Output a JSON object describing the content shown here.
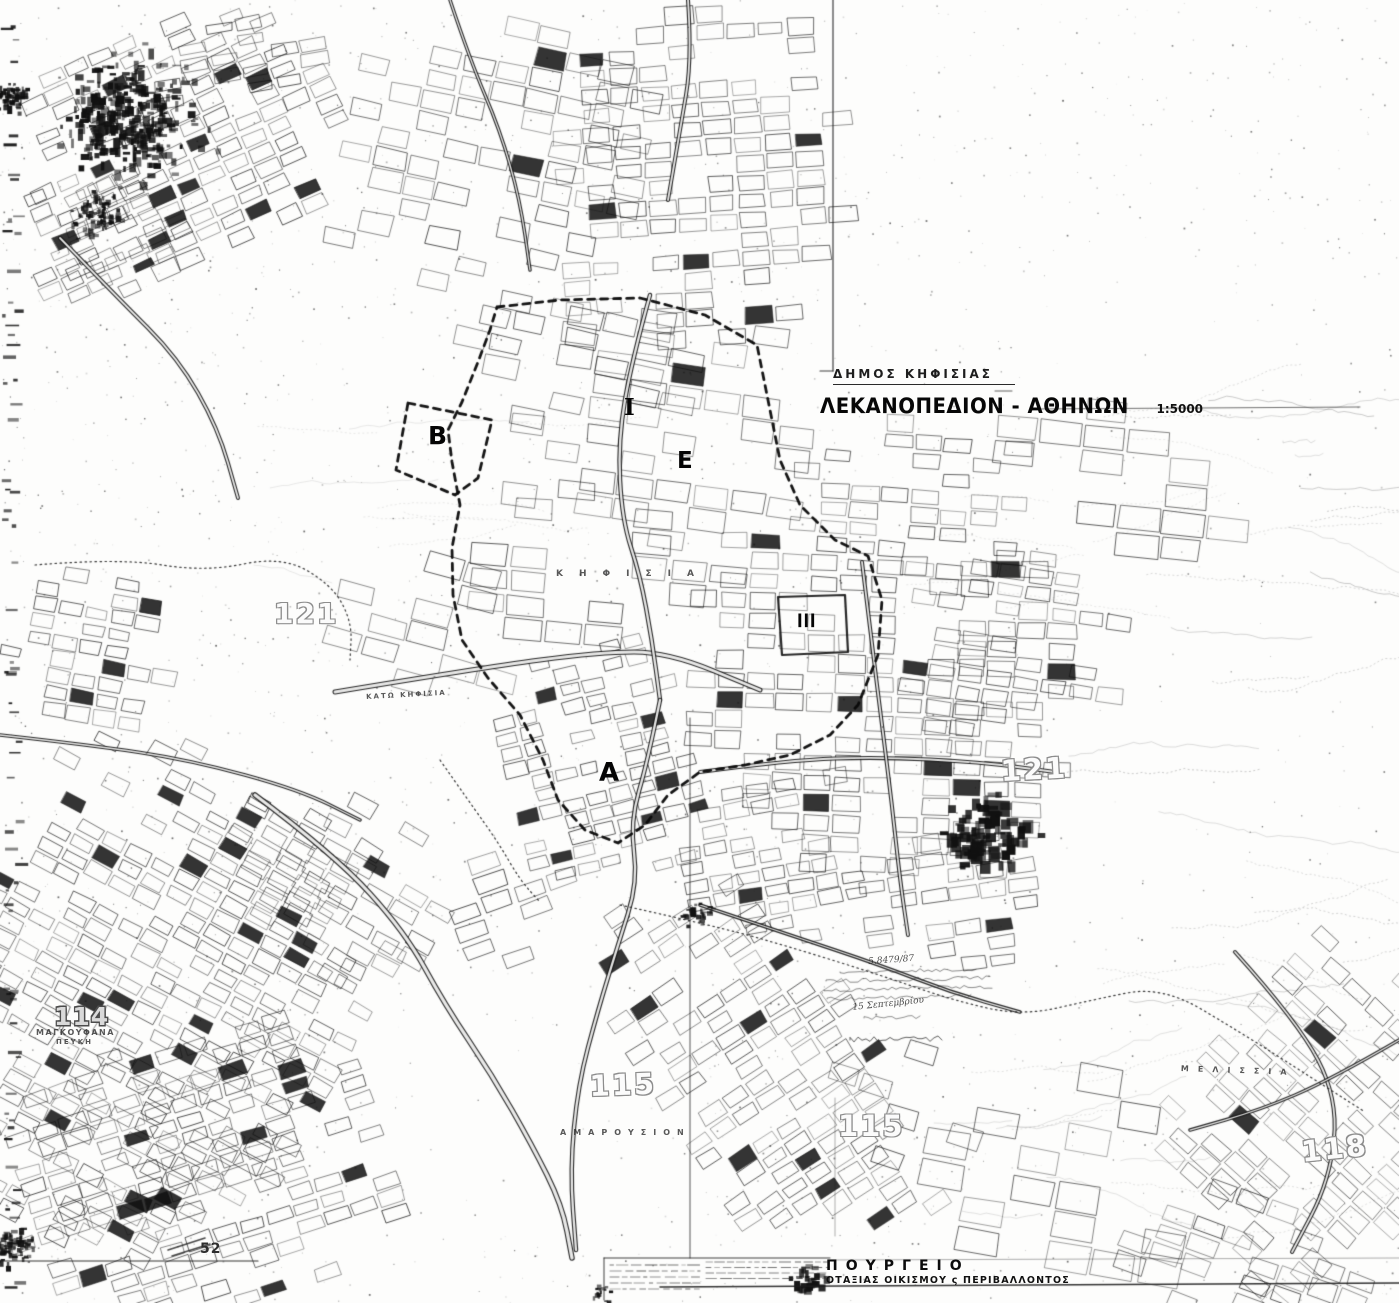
{
  "header": {
    "municipality": "ΔΗΜΟΣ ΚΗΦΙΣΙΑΣ",
    "title": "ΛΕΚΑΝΟΠΕΔΙΟΝ - ΑΘΗΝΩΝ",
    "scale": "1:5000"
  },
  "footer": {
    "ministry_line": "ΠΟΥΡΓΕΙΟ",
    "ministry_subline": "ΟΤΑΞΙΑΣ ΟΙΚΙΣΜΟΥ ς ΠΕΡΙΒΑΛΛΟΝΤΟΣ"
  },
  "annotation": {
    "reference": "5.8479/87",
    "date": "15 Σεπτεμβρίου"
  },
  "colors": {
    "ink": "#111111",
    "paper": "#fdfdfc",
    "faded": "#8d8d8d"
  },
  "labels": [
    {
      "name": "sheet-number-121-left",
      "text": "121",
      "x": 274,
      "y": 600,
      "cls": "outline",
      "fs": 28,
      "ls": 2
    },
    {
      "name": "sheet-number-121-right",
      "text": "121",
      "x": 1000,
      "y": 757,
      "cls": "outline",
      "fs": 29,
      "ls": 2,
      "rot": -3
    },
    {
      "name": "sheet-number-115-left",
      "text": "115",
      "x": 589,
      "y": 1072,
      "cls": "outline",
      "fs": 29,
      "ls": 2,
      "rot": -2
    },
    {
      "name": "sheet-number-115-right",
      "text": "115",
      "x": 838,
      "y": 1112,
      "cls": "outline",
      "fs": 29,
      "ls": 2
    },
    {
      "name": "sheet-number-118",
      "text": "118",
      "x": 1300,
      "y": 1138,
      "cls": "outline",
      "fs": 29,
      "ls": 2,
      "rot": -6
    },
    {
      "name": "sheet-number-114",
      "text": "114",
      "x": 54,
      "y": 1004,
      "cls": "outline-dk",
      "fs": 25,
      "ls": 1
    },
    {
      "name": "sheet-number-52",
      "text": "52",
      "x": 200,
      "y": 1242,
      "cls": "solid-num",
      "fs": 14,
      "ls": 1
    },
    {
      "name": "zone-letter-b",
      "text": "Β",
      "x": 428,
      "y": 423,
      "cls": "zone",
      "fs": 25
    },
    {
      "name": "zone-letter-e",
      "text": "Ε",
      "x": 677,
      "y": 450,
      "cls": "zone",
      "fs": 23
    },
    {
      "name": "zone-letter-a",
      "text": "Α",
      "x": 599,
      "y": 760,
      "cls": "zone",
      "fs": 26
    },
    {
      "name": "zone-numeral-i",
      "text": "Ι",
      "x": 624,
      "y": 396,
      "cls": "zone serif",
      "fs": 23
    },
    {
      "name": "zone-numeral-iii",
      "text": "ΙΙΙ",
      "x": 797,
      "y": 612,
      "cls": "zone",
      "fs": 19,
      "ls": 1,
      "sx": 0.8
    },
    {
      "name": "place-name-kifisia",
      "text": "ΚΗΦΙΣΙΑ",
      "x": 556,
      "y": 570,
      "cls": "place",
      "fs": 9,
      "ls": 16
    },
    {
      "name": "place-name-kato-kifisia",
      "text": "ΚΑΤΩ ΚΗΦΙΣΙΑ",
      "x": 366,
      "y": 694,
      "cls": "place",
      "fs": 7,
      "ls": 2,
      "rot": -3
    },
    {
      "name": "place-name-amarousion",
      "text": "ΑΜΑΡΟΥΣΙΟΝ",
      "x": 560,
      "y": 1129,
      "cls": "place",
      "fs": 8,
      "ls": 7
    },
    {
      "name": "place-name-melissia",
      "text": "ΜΕΛΙΣΣΙΑ",
      "x": 1181,
      "y": 1065,
      "cls": "place",
      "fs": 8,
      "ls": 9,
      "rot": 2
    },
    {
      "name": "place-name-magkoufana",
      "text": "ΜΑΓΚΟΥΦΑΝΑ",
      "x": 36,
      "y": 1029,
      "cls": "place",
      "fs": 8,
      "ls": 1.5
    },
    {
      "name": "place-name-pefki",
      "text": "ΠΕΥΚΗ",
      "x": 56,
      "y": 1039,
      "cls": "place",
      "fs": 7,
      "ls": 2
    },
    {
      "name": "annotation-reference",
      "text": "5.8479/87",
      "x": 868,
      "y": 958,
      "cls": "hand",
      "fs": 9,
      "rot": -4
    },
    {
      "name": "annotation-date",
      "text": "15 Σεπτεμβρίου",
      "x": 852,
      "y": 1004,
      "cls": "hand",
      "fs": 9,
      "rot": -6
    }
  ]
}
